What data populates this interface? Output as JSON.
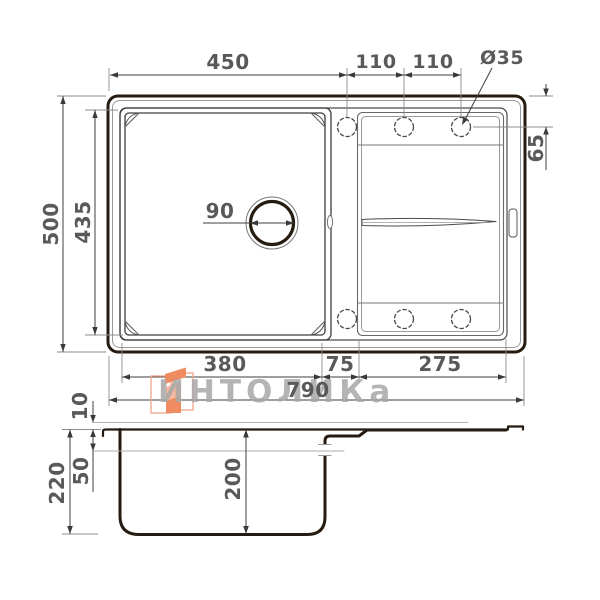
{
  "watermark": {
    "text": "ИНТОЛИКа"
  },
  "top_view": {
    "bowl_width": "450",
    "hole_pitch_left": "110",
    "hole_pitch_right": "110",
    "hole_diameter": "Ø35",
    "hole_offset_from_edge": "65",
    "overall_depth": "500",
    "bowl_length": "435",
    "drain_diameter": "90",
    "bowl_inner_width": "380",
    "bowl_to_board_gap": "75",
    "drainboard_width": "275",
    "overall_width": "790"
  },
  "side_view": {
    "rim_height": "10",
    "overall_height": "220",
    "overflow_level": "50",
    "bowl_depth": "200"
  },
  "colors": {
    "line_ink": "#261b10",
    "dim_text": "#595959",
    "dim_line": "#3f3f3f",
    "extension_line": "#8c8c8c",
    "watermark_text": "#a8a8a8",
    "logo_orange": "#ef8b60",
    "logo_orange_light": "#f7b89e",
    "logo_outline": "#f2a488"
  }
}
